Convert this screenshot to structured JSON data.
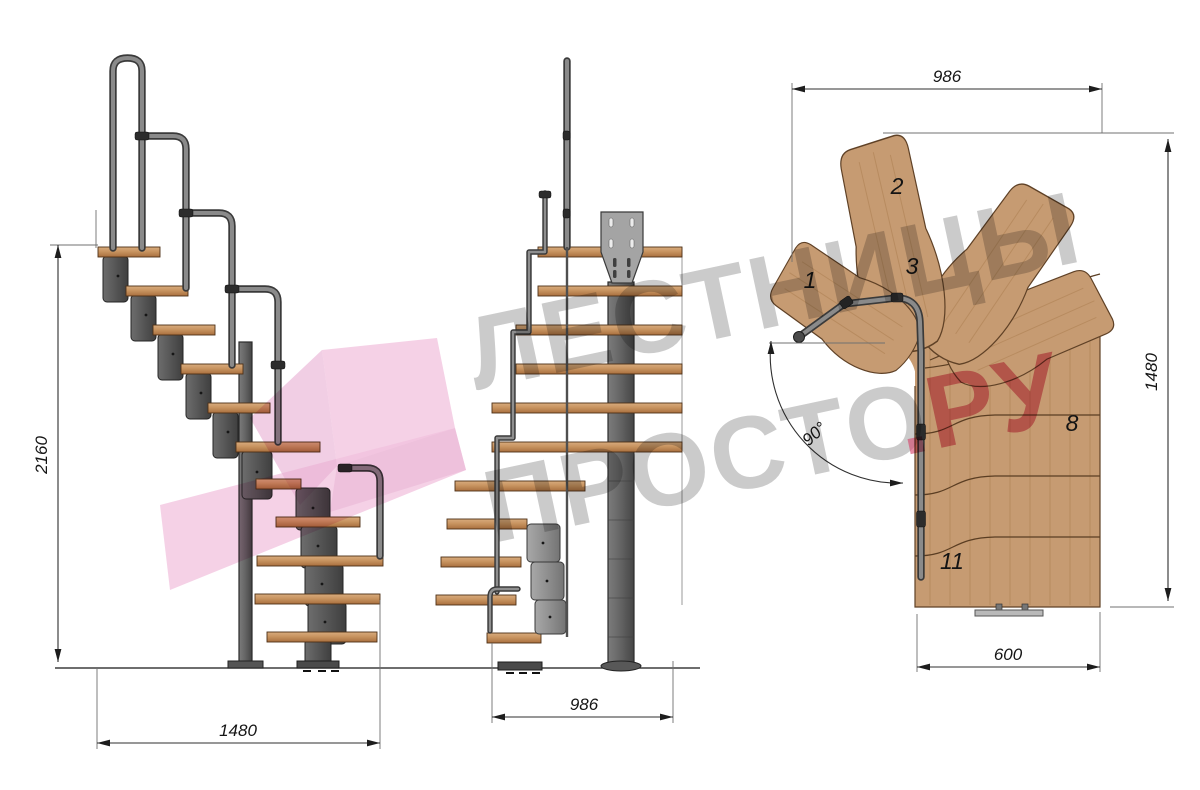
{
  "watermark": {
    "line1": "ЛЕСТНИЦЫ",
    "line2": "ПРОСТО",
    "line2_suffix": ".РУ",
    "gray": "#9c9c9c",
    "red": "#d5456b",
    "pink": "#f2c2de"
  },
  "dims": {
    "side_height": "2160",
    "side_run": "1480",
    "front_width": "986",
    "plan_width": "986",
    "plan_depth": "1480",
    "plan_tread_width": "600",
    "plan_angle": "90°"
  },
  "tread_labels": {
    "t1": "1",
    "t2": "2",
    "t3": "3",
    "t8": "8",
    "t11": "11"
  },
  "colors": {
    "wood_light": "#d6ab7e",
    "wood_dark": "#b07747",
    "plan_wood": "#c69b72",
    "metal_dark": "#4f4f4f",
    "metal_mid": "#6b6b6b",
    "plate": "#a4a4a4",
    "background": "#ffffff"
  }
}
